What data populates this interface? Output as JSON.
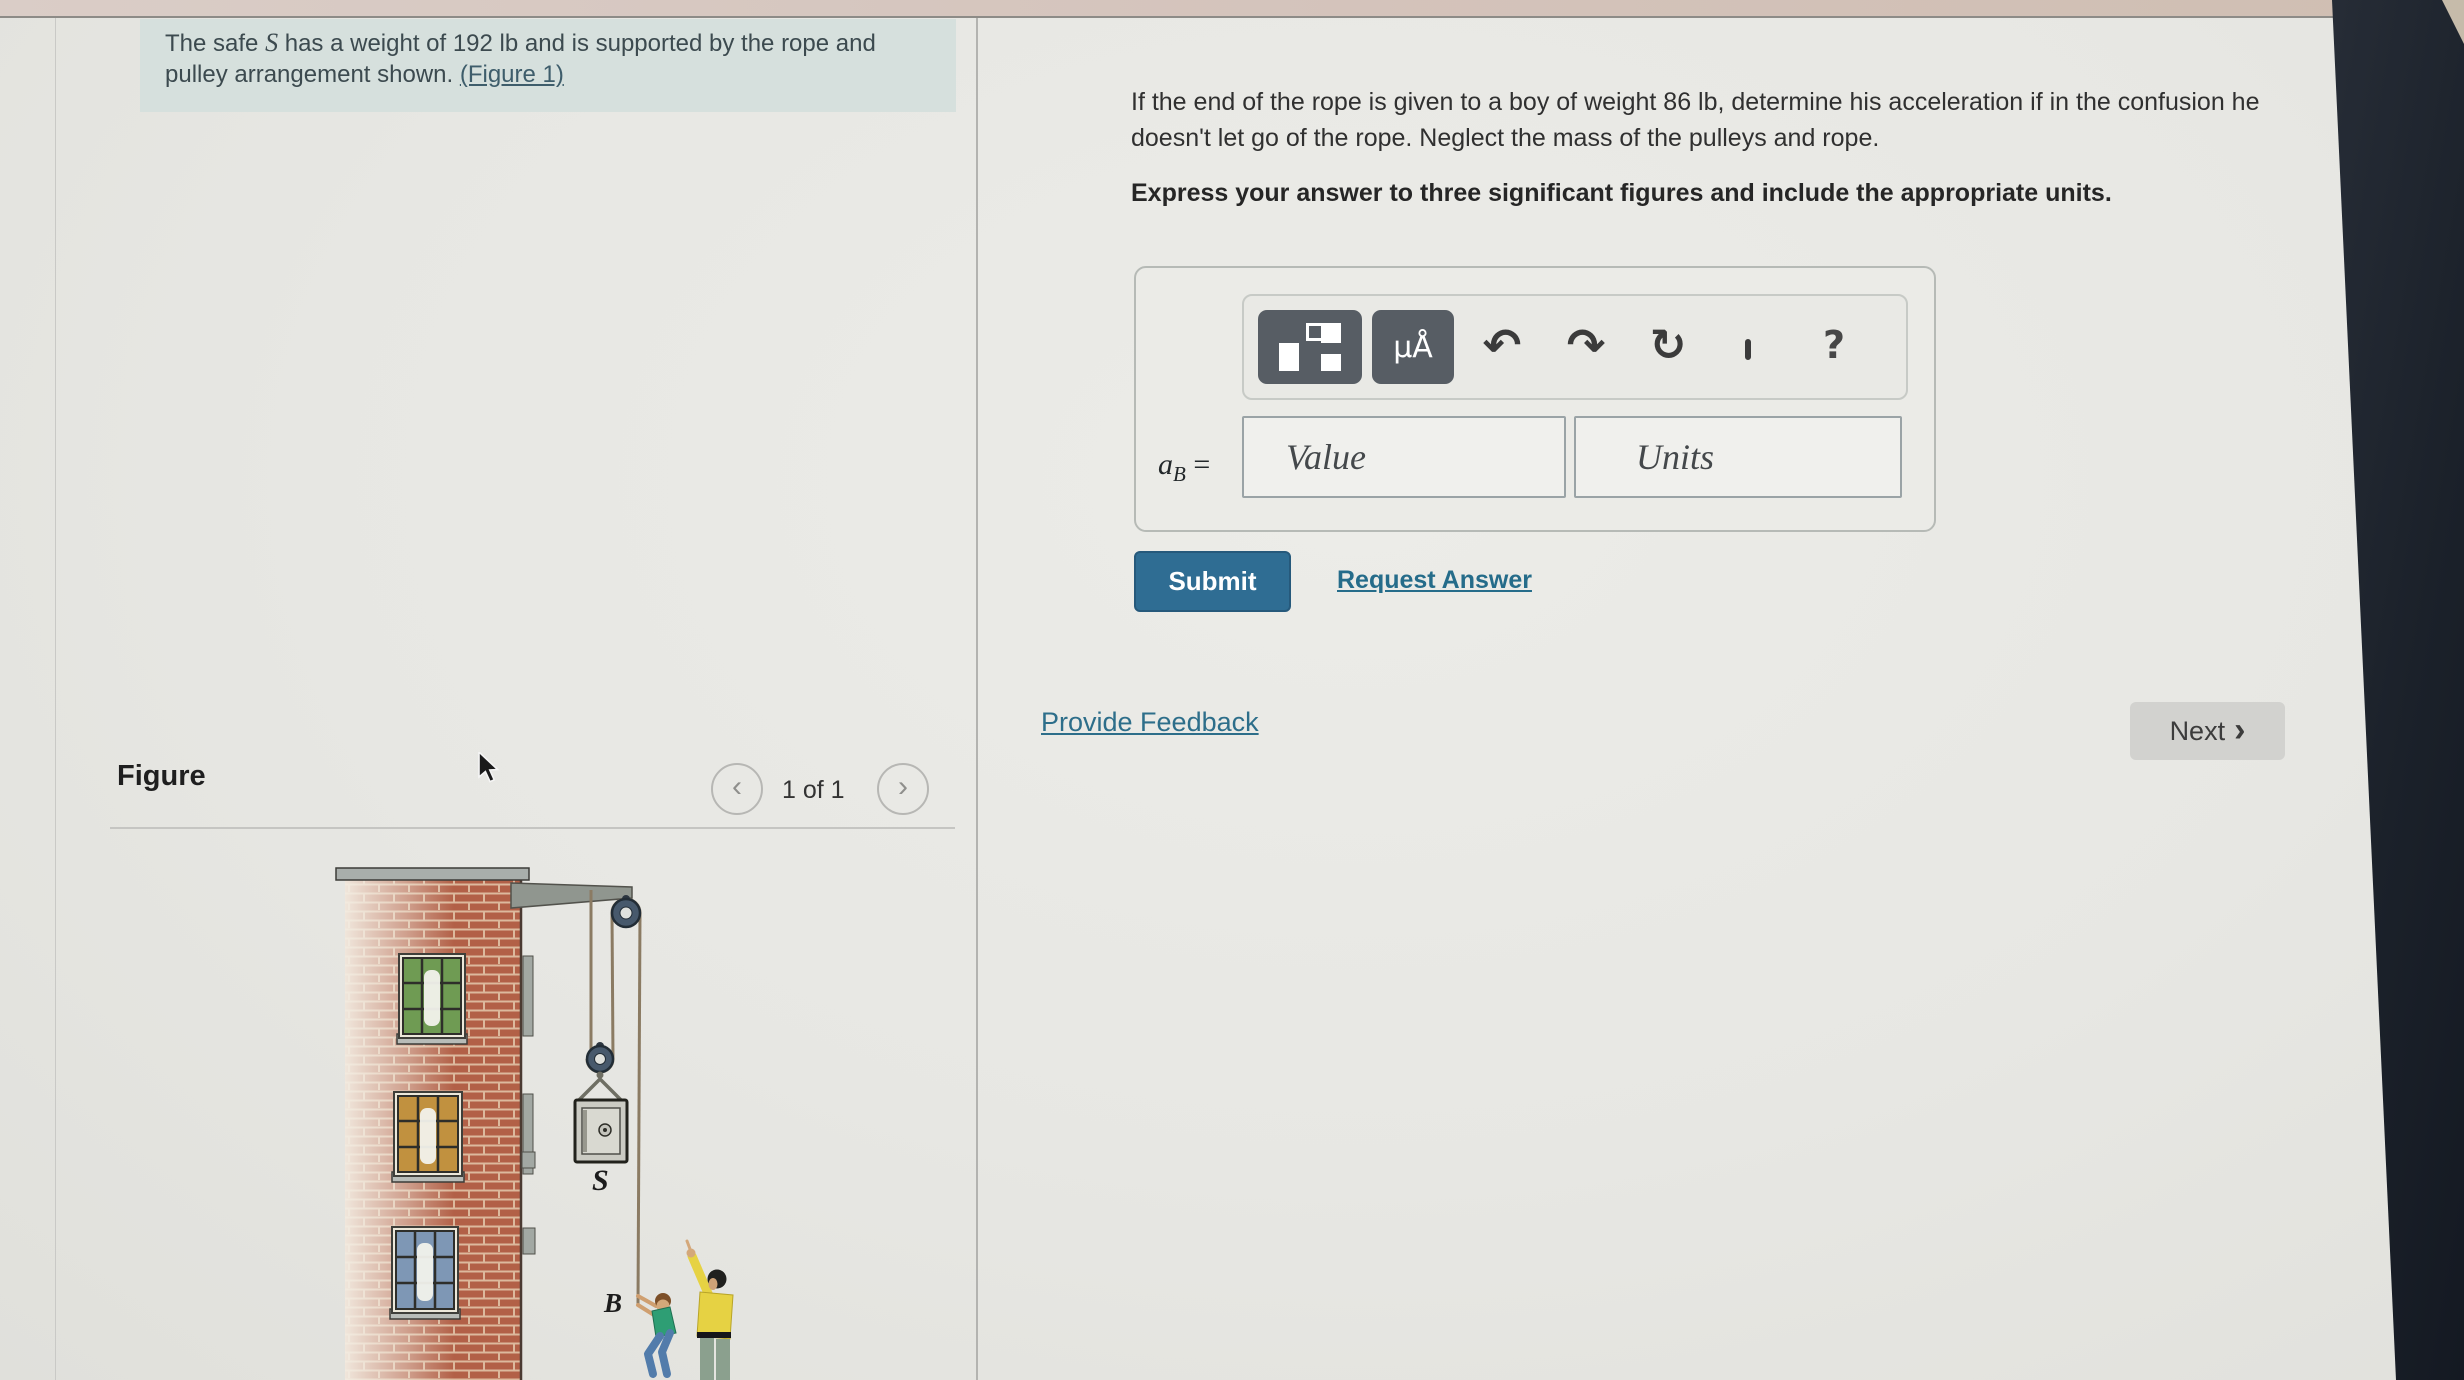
{
  "problem": {
    "text_before_S": "The safe ",
    "var_S": "S",
    "text_after_S": " has a weight of 192 lb and is supported by the rope and pulley arrangement shown. ",
    "figure_link": "(Figure 1)"
  },
  "question": {
    "text": "If the end of the rope is given to a boy of weight 86 lb, determine his acceleration if in the confusion he doesn't let go of the rope. Neglect the mass of the pulleys and rope.",
    "instruction": "Express your answer to three significant figures and include the appropriate units."
  },
  "answer": {
    "variable": "a",
    "variable_sub": "B",
    "equals": " =",
    "value_placeholder": "Value",
    "units_placeholder": "Units",
    "toolbar": {
      "units_button": "μÅ",
      "undo": "↶",
      "redo": "↷",
      "reset": "↻",
      "help": "?"
    },
    "submit": "Submit",
    "request_answer": "Request Answer"
  },
  "footer": {
    "provide_feedback": "Provide Feedback",
    "next_label": "Next",
    "next_chevron": "›"
  },
  "figure_panel": {
    "title": "Figure",
    "pagination": "1 of 1",
    "prev_chevron": "‹",
    "next_chevron": "›",
    "label_safe": "S",
    "label_boy": "B"
  },
  "colors": {
    "accent_link": "#256c8a",
    "submit_bg": "#2f6d93",
    "highlight_bg": "#d6e0dd",
    "dark_bar": "#1b212a",
    "top_bar": "#d4c3bb"
  }
}
